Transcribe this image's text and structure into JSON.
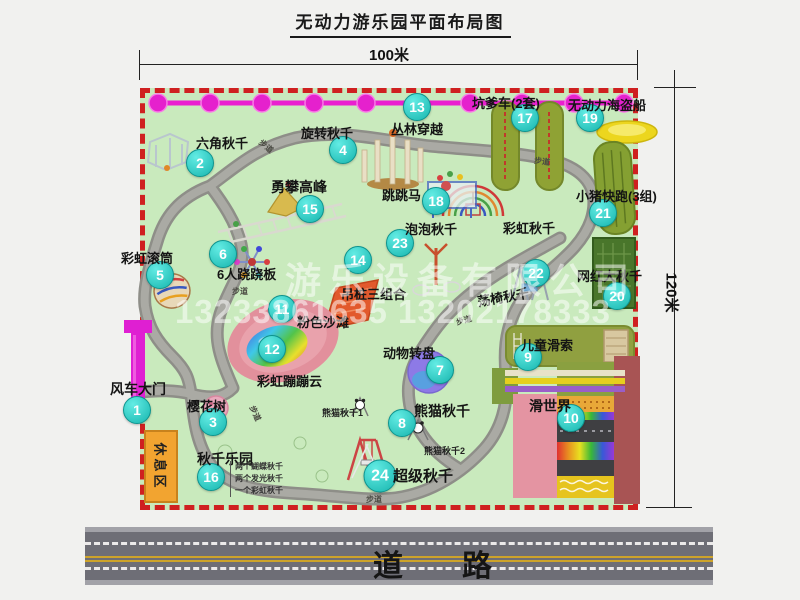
{
  "title": "无动力游乐园平面布局图",
  "dimensions": {
    "width_label": "100米",
    "height_label": "120米"
  },
  "labels": {
    "trail": "步道",
    "rainbow_swing": "彩虹秋千"
  },
  "rest_area": {
    "label": "休息区"
  },
  "road": {
    "label": "道路"
  },
  "watermark": {
    "company": "游乐设备有限公司",
    "phone": "13233861635 13202178333"
  },
  "attractions": [
    {
      "num": "1",
      "name": "风车大门"
    },
    {
      "num": "2",
      "name": "六角秋千"
    },
    {
      "num": "3",
      "name": "樱花树"
    },
    {
      "num": "4",
      "name": "旋转秋千"
    },
    {
      "num": "5",
      "name": "彩虹滚筒"
    },
    {
      "num": "6",
      "name": "6人跷跷板"
    },
    {
      "num": "7",
      "name": "动物转盘"
    },
    {
      "num": "8",
      "name": "熊猫秋千"
    },
    {
      "num": "9",
      "name": "儿童滑索"
    },
    {
      "num": "10",
      "name": "滑世界"
    },
    {
      "num": "11",
      "name": "粉色沙滩"
    },
    {
      "num": "12",
      "name": "彩虹蹦蹦云"
    },
    {
      "num": "13",
      "name": "丛林穿越"
    },
    {
      "num": "14",
      "name": "吊桩三组合"
    },
    {
      "num": "15",
      "name": "勇攀高峰"
    },
    {
      "num": "16",
      "name": "秋千乐园"
    },
    {
      "num": "17",
      "name": "坑爹车(2套)"
    },
    {
      "num": "18",
      "name": "跳跳马"
    },
    {
      "num": "19",
      "name": "无动力海盗船"
    },
    {
      "num": "20",
      "name": "网红大秋千"
    },
    {
      "num": "21",
      "name": "小猪快跑(3组)"
    },
    {
      "num": "22",
      "name": "荡椅秋千"
    },
    {
      "num": "23",
      "name": "泡泡秋千"
    },
    {
      "num": "24",
      "name": "超级秋千"
    }
  ],
  "panda_sub": [
    "熊猫秋千1",
    "熊猫秋千2"
  ],
  "swing_park_details": [
    "两个蝴蝶秋千",
    "两个发光秋千",
    "一个彩虹秋千"
  ],
  "colors": {
    "map_background": "#c9eabd",
    "map_border": "#cf2020",
    "badge": "#17b5ae",
    "chain": "#e521cd",
    "gate": "#df1fd2",
    "rest_area": "#f2a430"
  }
}
